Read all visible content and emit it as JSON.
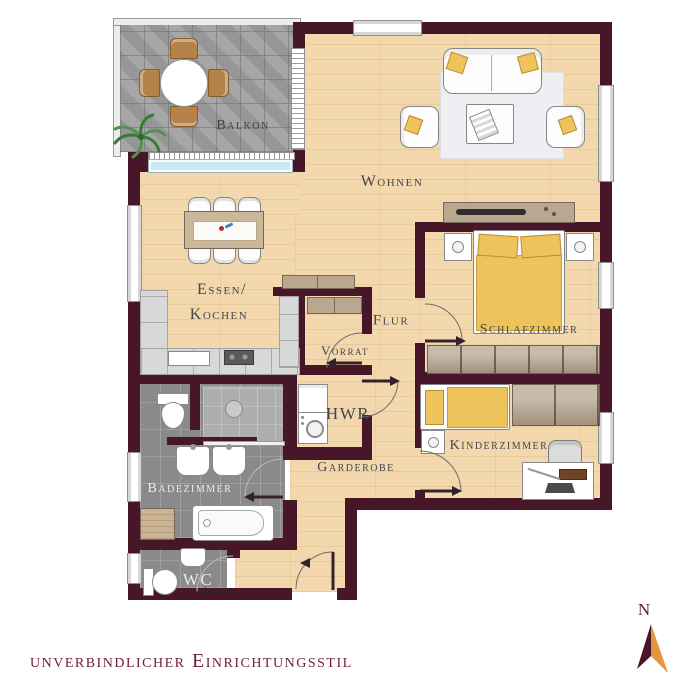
{
  "floorplan": {
    "caption": "unverbindlicher Einrichtungsstil",
    "compass": {
      "label": "N"
    },
    "rooms": {
      "balkon": {
        "label": "Balkon"
      },
      "wohnen": {
        "label": "Wohnen"
      },
      "essen_kochen": {
        "line1": "Essen/",
        "line2": "Kochen"
      },
      "flur": {
        "label": "Flur"
      },
      "vorrat": {
        "label": "Vorrat"
      },
      "schlafzimmer": {
        "label": "Schlafzimmer"
      },
      "hwr": {
        "label": "HWR"
      },
      "kinderzimmer": {
        "label": "Kinderzimmer"
      },
      "badezimmer": {
        "label": "Badezimmer"
      },
      "garderobe": {
        "label": "Garderobe"
      },
      "wc": {
        "label": "WC"
      }
    },
    "colors": {
      "wall": "#471628",
      "wood_floor": "#f2d8ac",
      "balcony_tile": "#9f9f9f",
      "bath_tile": "#8a8a8a",
      "accent_yellow": "#eec35b",
      "window_glass_blue": "#cfe7f2",
      "label_text": "#45454e",
      "caption_text": "#70203c",
      "compass_orange": "#e6953f"
    }
  }
}
